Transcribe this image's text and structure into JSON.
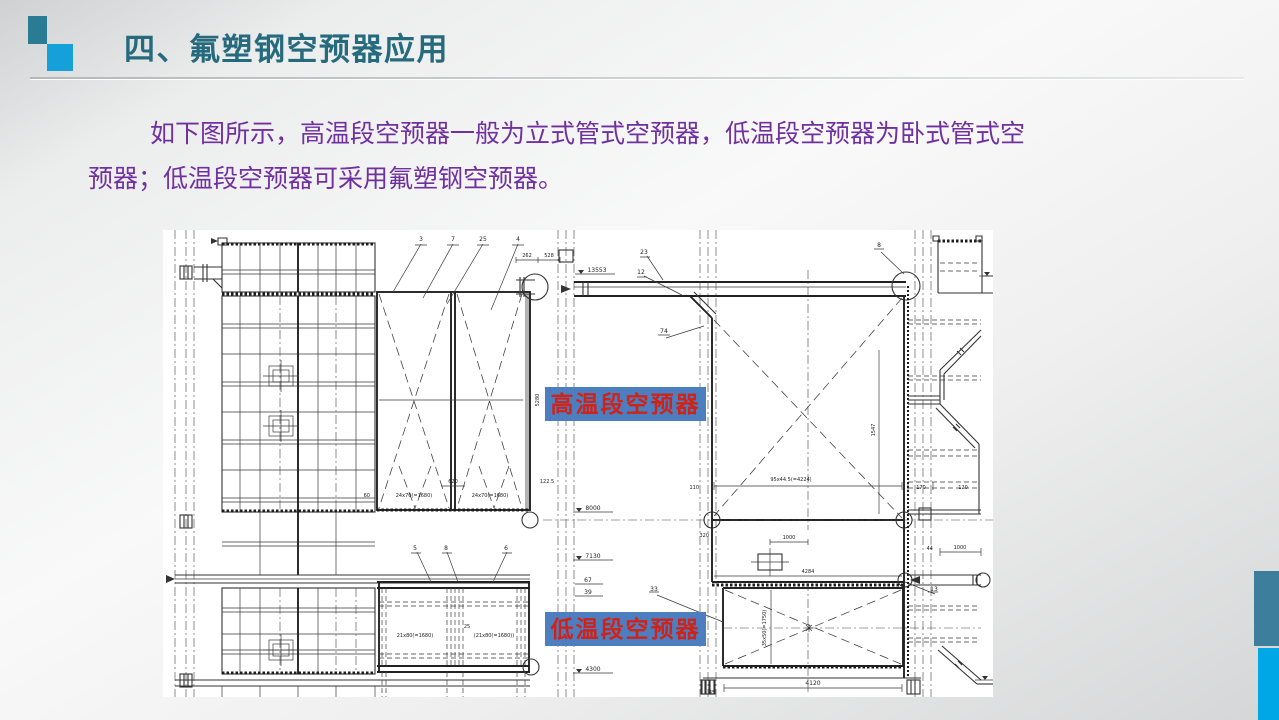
{
  "slide": {
    "title": "四、氟塑钢空预器应用",
    "body": {
      "line1": "如下图所示，高温段空预器一般为立式管式空预器，低温段空预器为卧式管式空",
      "line2": "预器；低温段空预器可采用氟塑钢空预器。"
    },
    "colors": {
      "title_text": "#266b7d",
      "body_text": "#7030a0",
      "accent_square_dark": "#2a7c94",
      "accent_square_light": "#16a0d9",
      "side_bar_teal": "#3d7e9d",
      "side_bar_blue": "#00a7e7",
      "callout_background": "#4d7ec0",
      "callout_text": "#d02318"
    }
  },
  "diagram": {
    "callouts": {
      "high_temp": "高温段空预器",
      "low_temp": "低温段空预器"
    },
    "dims": {
      "d262": "262",
      "d528": "528",
      "e13553": "13553",
      "p3": "3",
      "p7": "7",
      "p25": "25",
      "p4": "4",
      "p23": "23",
      "p12": "12",
      "p74": "74",
      "p8t": "8",
      "d60": "60",
      "d620": "620",
      "d122_5": "122.5",
      "d5280": "5280",
      "d24x70a": "24x70(=1680)",
      "d24x70b": "24x70(=1680)",
      "e8000": "8000",
      "e7130": "7130",
      "e67": "67",
      "e39": "39",
      "e4300": "4300",
      "p5": "5",
      "p8": "8",
      "p6": "6",
      "d25s": "25",
      "d21x80a": "21x80(=1680)",
      "d21x80b": "(21x80(=1680))",
      "d110": "110",
      "d95x44": "95x44.5(=4224)",
      "d170": "170",
      "d120": "120",
      "d1547": "1547",
      "d320": "320",
      "d1000a": "1000",
      "d4284": "4284",
      "d35x50": "35x50(=1750)",
      "d4120": "4120",
      "d45": "45",
      "p33": "33",
      "p13": "13",
      "d44": "44",
      "d1000b": "1000"
    }
  }
}
